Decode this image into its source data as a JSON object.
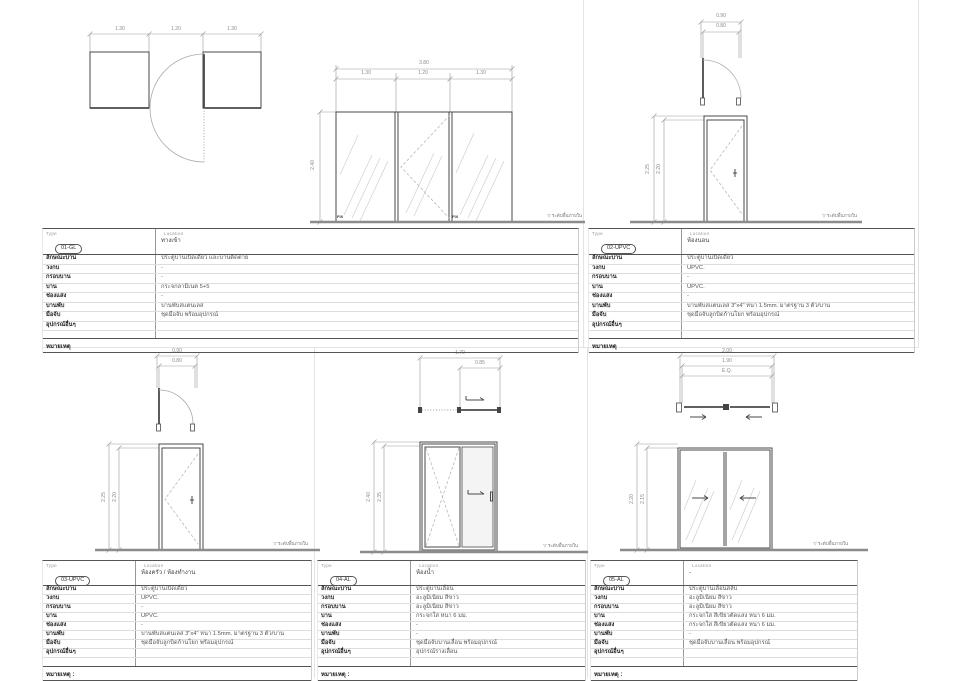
{
  "sheet": {
    "bg": "#ffffff",
    "line_dark": "#4a4a4a",
    "line_dim": "#9a9a9a",
    "line_glass": "#cfcfcf",
    "line_floor": "#8c8c8c"
  },
  "labels": {
    "type": "Type",
    "location": "Location",
    "fix": "FIX",
    "level_icon": "▽",
    "floor_level": "ระดับพื้นภายใน"
  },
  "row_labels": [
    "ลักษณะบาน",
    "วงกบ",
    "กรอบบาน",
    "บาน",
    "ช่องแสง",
    "บานพับ",
    "มือจับ",
    "อุปกรณ์อื่นๆ"
  ],
  "panels": [
    {
      "id": "01-GL",
      "location": "ทางเข้า",
      "remark": "หมายเหตุ",
      "values": [
        "ประตูบานเปิดเดี่ยว และบานติดตาย",
        "-",
        "-",
        "กระจกลามิเนต 5+5",
        "-",
        "บานพับสแตนเลส",
        "ชุดมือจับ พร้อมอุปกรณ์",
        ""
      ],
      "dims": {
        "plan": [
          "1.30",
          "1.20",
          "1.30"
        ],
        "total": "3.80",
        "segs": [
          "1.30",
          "1.20",
          "1.30"
        ],
        "height": "2.40"
      }
    },
    {
      "id": "02-UPVC",
      "location": "ห้องนอน",
      "remark": "หมายเหตุ",
      "values": [
        "ประตูบานเปิดเดี่ยว",
        "UPVC.",
        "-",
        "UPVC.",
        "-",
        "บานพับสแตนเลส 3\"x4\" หนา 1.5mm. มาตรฐาน 3 ตัว/บาน",
        "ชุดมือจับลูกบิดก้านโยก พร้อมอุปกรณ์",
        ""
      ],
      "dims": {
        "w_out": "0.90",
        "w_in": "0.80",
        "h_out": "2.25",
        "h_in": "2.20"
      }
    },
    {
      "id": "03-UPVC",
      "location": "ห้องครัว / ห้องทำงาน",
      "remark": "หมายเหตุ :",
      "values": [
        "ประตูบานเปิดเดี่ยว",
        "UPVC.",
        "-",
        "UPVC.",
        "-",
        "บานพับสแตนเลส 3\"x4\" หนา 1.5mm. มาตรฐาน 3 ตัว/บาน",
        "ชุดมือจับลูกบิดก้านโยก พร้อมอุปกรณ์",
        ""
      ],
      "dims": {
        "w_out": "0.90",
        "w_in": "0.80",
        "h_out": "2.25",
        "h_in": "2.20"
      }
    },
    {
      "id": "04-AL",
      "location": "ห้องน้ำ",
      "remark": "หมายเหตุ :",
      "values": [
        "ประตูบานเลื่อน",
        "อะลูมิเนียม สีขาว",
        "อะลูมิเนียม สีขาว",
        "กระจกใส หนา 6 มม.",
        "-",
        "-",
        "ชุดมือจับบานเลื่อน พร้อมอุปกรณ์",
        "อุปกรณ์รางเลื่อน"
      ],
      "dims": {
        "w_out": "1.70",
        "w_in": "0.85",
        "h_out": "2.40",
        "h_in": "2.35"
      }
    },
    {
      "id": "05-AL",
      "location": "-",
      "remark": "หมายเหตุ :",
      "values": [
        "ประตูบานเลื่อนสลับ",
        "อะลูมิเนียม สีขาว",
        "อะลูมิเนียม สีขาว",
        "กระจกใส สีเขียวตัดแสง หนา 6 มม.",
        "กระจกใส สีเขียวตัดแสง หนา 6 มม.",
        "-",
        "ชุดมือจับบานเลื่อน พร้อมอุปกรณ์",
        ""
      ],
      "dims": {
        "w_out": "2.00",
        "w_in": "1.90",
        "w_eq": "E.Q.",
        "h_out": "2.20",
        "h_in": "2.15"
      }
    }
  ]
}
